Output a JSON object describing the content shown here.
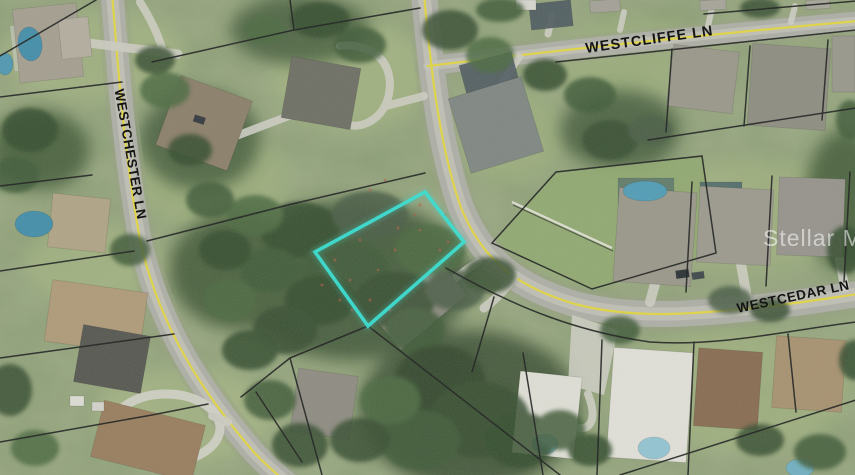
{
  "map": {
    "streets": [
      {
        "id": "westcliffe",
        "name": "WESTCLIFFE LN"
      },
      {
        "id": "westchester",
        "name": "WESTCHESTER LN"
      },
      {
        "id": "westcedar",
        "name": "WESTCEDAR LN"
      }
    ],
    "watermark": {
      "text": "Stellar MLS"
    },
    "highlight_parcel": {
      "points": "425,192 464,242 368,326 315,252",
      "color": "#2fe3d6"
    },
    "colors": {
      "street_centerline": "#e8d93c",
      "parcel_line": "#161616",
      "street_label": "#141414",
      "road_asphalt": "#b0afa6",
      "highlight": "#2fe3d6"
    }
  }
}
